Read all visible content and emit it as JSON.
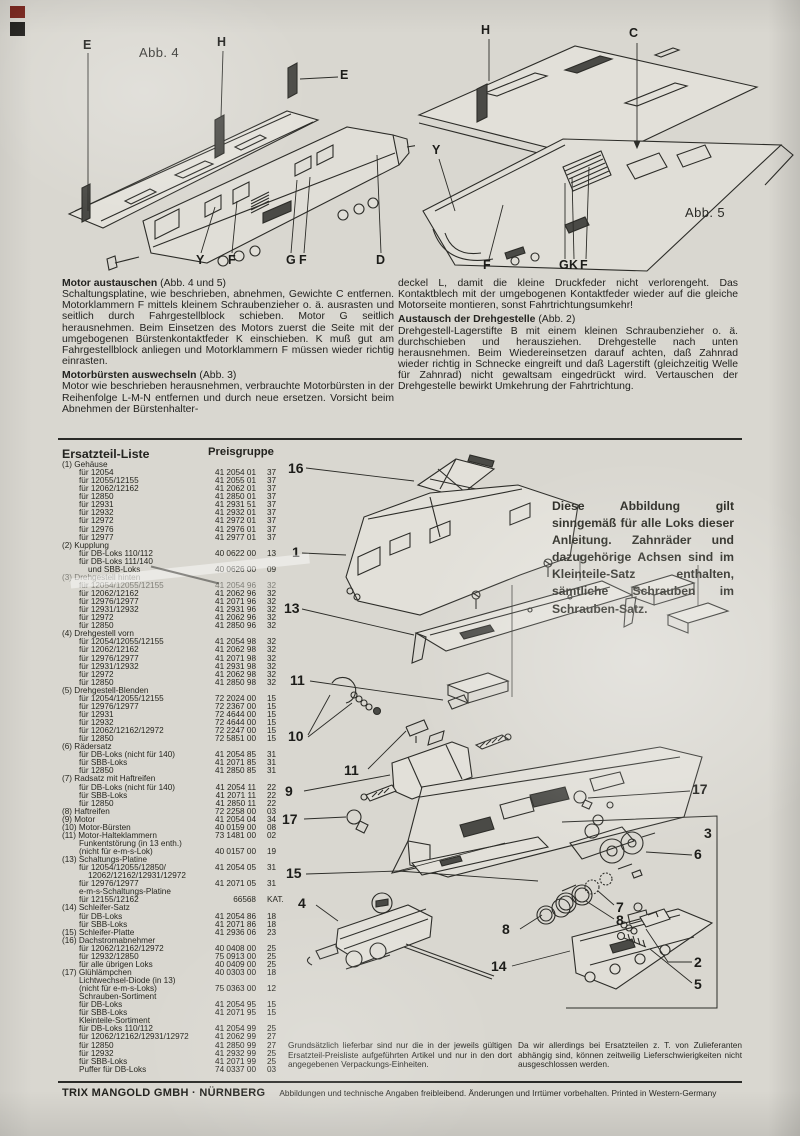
{
  "document": {
    "figures": {
      "fig4": {
        "caption": "Abb. 4",
        "labels": [
          {
            "t": "E",
            "x": 28,
            "y": 14
          },
          {
            "t": "H",
            "x": 162,
            "y": 11
          },
          {
            "t": "E",
            "x": 285,
            "y": 44
          },
          {
            "t": "Y",
            "x": 141,
            "y": 229
          },
          {
            "t": "F",
            "x": 173,
            "y": 229
          },
          {
            "t": "G",
            "x": 231,
            "y": 229
          },
          {
            "t": "F",
            "x": 244,
            "y": 229
          },
          {
            "t": "D",
            "x": 321,
            "y": 229
          }
        ]
      },
      "fig5": {
        "caption": "Abb. 5",
        "labels": [
          {
            "t": "H",
            "x": 66,
            "y": 9
          },
          {
            "t": "C",
            "x": 214,
            "y": 12
          },
          {
            "t": "Y",
            "x": 17,
            "y": 129
          },
          {
            "t": "F",
            "x": 68,
            "y": 244
          },
          {
            "t": "G",
            "x": 144,
            "y": 244
          },
          {
            "t": "K",
            "x": 154,
            "y": 244
          },
          {
            "t": "F",
            "x": 165,
            "y": 244
          }
        ]
      }
    },
    "instructions": {
      "left": [
        {
          "head": "Motor austauschen",
          "head_rest": " (Abb. 4 und 5)",
          "body": "Schaltungsplatine, wie beschrieben, abnehmen, Gewichte C entfernen. Motorklammern F mittels kleinem Schraubenzieher o. ä. ausrasten und seitlich durch Fahrgestellblock schieben. Motor G seitlich herausnehmen. Beim Einsetzen des Motors zuerst die Seite mit der umgebogenen Bürstenkontaktfeder K einschieben. K muß gut am Fahrgestellblock anliegen und Motorklammern F müssen wieder richtig einrasten."
        },
        {
          "head": "Motorbürsten auswechseln",
          "head_rest": " (Abb. 3)",
          "body": "Motor wie beschrieben herausnehmen, verbrauchte Motorbürsten in der Reihenfolge L-M-N entfernen und durch neue ersetzen. Vorsicht beim Abnehmen der Bürstenhalter-"
        }
      ],
      "right": [
        {
          "body": "deckel L, damit die kleine Druckfeder nicht verlorengeht. Das Kontaktblech mit der umgebogenen Kontaktfeder wieder auf die gleiche Motorseite montieren, sonst Fahrtrichtungsumkehr!"
        },
        {
          "head": "Austausch der Drehgestelle",
          "head_rest": " (Abb. 2)",
          "body": "Drehgestell-Lagerstifte B mit einem kleinen Schraubenzieher o. ä. durchschieben und herausziehen. Drehgestelle nach unten herausnehmen. Beim Wiedereinsetzen darauf achten, daß Zahnrad wieder richtig in Schnecke eingreift und daß Lagerstift (gleichzeitig Welle für Zahnrad) nicht gewaltsam eingedrückt wird. Vertauschen der Drehgestelle bewirkt Umkehrung der Fahrtrichtung."
        }
      ]
    },
    "parts": {
      "title": "Ersatzteil-Liste",
      "price_header": "Preisgruppe",
      "rows": [
        {
          "i": 0,
          "t": "(1) Gehäuse"
        },
        {
          "i": 1,
          "t": "für 12054",
          "p": "41 2054 01",
          "g": "37"
        },
        {
          "i": 1,
          "t": "für 12055/12155",
          "p": "41 2055 01",
          "g": "37"
        },
        {
          "i": 1,
          "t": "für 12062/12162",
          "p": "41 2062 01",
          "g": "37"
        },
        {
          "i": 1,
          "t": "für 12850",
          "p": "41 2850 01",
          "g": "37"
        },
        {
          "i": 1,
          "t": "für 12931",
          "p": "41 2931 51",
          "g": "37"
        },
        {
          "i": 1,
          "t": "für 12932",
          "p": "41 2932 01",
          "g": "37"
        },
        {
          "i": 1,
          "t": "für 12972",
          "p": "41 2972 01",
          "g": "37"
        },
        {
          "i": 1,
          "t": "für 12976",
          "p": "41 2976 01",
          "g": "37"
        },
        {
          "i": 1,
          "t": "für 12977",
          "p": "41 2977 01",
          "g": "37"
        },
        {
          "i": 0,
          "t": "(2) Kupplung"
        },
        {
          "i": 1,
          "t": "für DB-Loks 110/112",
          "p": "40 0622 00",
          "g": "13"
        },
        {
          "i": 1,
          "t": "für DB-Loks 111/140"
        },
        {
          "i": 2,
          "t": "und SBB-Loks",
          "p": "40 0626 00",
          "g": "09"
        },
        {
          "i": 0,
          "t": "(3) Drehgestell hinten",
          "f": 1
        },
        {
          "i": 1,
          "t": "für 12054/12055/12155",
          "p": "41 2054 96",
          "g": "32",
          "f": 1
        },
        {
          "i": 1,
          "t": "für 12062/12162",
          "p": "41 2062 96",
          "g": "32"
        },
        {
          "i": 1,
          "t": "für 12976/12977",
          "p": "41 2071 96",
          "g": "32"
        },
        {
          "i": 1,
          "t": "für 12931/12932",
          "p": "41 2931 96",
          "g": "32"
        },
        {
          "i": 1,
          "t": "für 12972",
          "p": "41 2062 96",
          "g": "32"
        },
        {
          "i": 1,
          "t": "für 12850",
          "p": "41 2850 96",
          "g": "32"
        },
        {
          "i": 0,
          "t": "(4) Drehgestell vorn"
        },
        {
          "i": 1,
          "t": "für 12054/12055/12155",
          "p": "41 2054 98",
          "g": "32"
        },
        {
          "i": 1,
          "t": "für 12062/12162",
          "p": "41 2062 98",
          "g": "32"
        },
        {
          "i": 1,
          "t": "für 12976/12977",
          "p": "41 2071 98",
          "g": "32"
        },
        {
          "i": 1,
          "t": "für 12931/12932",
          "p": "41 2931 98",
          "g": "32"
        },
        {
          "i": 1,
          "t": "für 12972",
          "p": "41 2062 98",
          "g": "32"
        },
        {
          "i": 1,
          "t": "für 12850",
          "p": "41 2850 98",
          "g": "32"
        },
        {
          "i": 0,
          "t": "(5) Drehgestell-Blenden"
        },
        {
          "i": 1,
          "t": "für 12054/12055/12155",
          "p": "72 2024 00",
          "g": "15"
        },
        {
          "i": 1,
          "t": "für 12976/12977",
          "p": "72 2367 00",
          "g": "15"
        },
        {
          "i": 1,
          "t": "für 12931",
          "p": "72 4644 00",
          "g": "15"
        },
        {
          "i": 1,
          "t": "für 12932",
          "p": "72 4644 00",
          "g": "15"
        },
        {
          "i": 1,
          "t": "für 12062/12162/12972",
          "p": "72 2247 00",
          "g": "15"
        },
        {
          "i": 1,
          "t": "für 12850",
          "p": "72 5851 00",
          "g": "15"
        },
        {
          "i": 0,
          "t": "(6) Rädersatz"
        },
        {
          "i": 1,
          "t": "für DB-Loks (nicht für 140)",
          "p": "41 2054 85",
          "g": "31"
        },
        {
          "i": 1,
          "t": "für SBB-Loks",
          "p": "41 2071 85",
          "g": "31"
        },
        {
          "i": 1,
          "t": "für 12850",
          "p": "41 2850 85",
          "g": "31"
        },
        {
          "i": 0,
          "t": "(7) Radsatz mit Haftreifen"
        },
        {
          "i": 1,
          "t": "für DB-Loks (nicht für 140)",
          "p": "41 2054 11",
          "g": "22"
        },
        {
          "i": 1,
          "t": "für SBB-Loks",
          "p": "41 2071 11",
          "g": "22"
        },
        {
          "i": 1,
          "t": "für 12850",
          "p": "41 2850 11",
          "g": "22"
        },
        {
          "i": 0,
          "t": "(8) Haftreifen",
          "p": "72 2258 00",
          "g": "03"
        },
        {
          "i": 0,
          "t": "(9) Motor",
          "p": "41 2054 04",
          "g": "34"
        },
        {
          "i": 0,
          "t": "(10) Motor-Bürsten",
          "p": "40 0159 00",
          "g": "08"
        },
        {
          "i": 0,
          "t": "(11) Motor-Halteklammern",
          "p": "73 1481 00",
          "g": "02"
        },
        {
          "i": 1,
          "t": "Funkentstörung (in 13 enth.)"
        },
        {
          "i": 1,
          "t": "(nicht für e-m-s-Lok)",
          "p": "40 0157 00",
          "g": "19"
        },
        {
          "i": 0,
          "t": "(13) Schaltungs-Platine"
        },
        {
          "i": 1,
          "t": "für 12054/12055/12850/",
          "p": "41 2054 05",
          "g": "31"
        },
        {
          "i": 2,
          "t": "12062/12162/12931/12972"
        },
        {
          "i": 1,
          "t": "für 12976/12977",
          "p": "41 2071 05",
          "g": "31"
        },
        {
          "i": 1,
          "t": "e-m-s-Schaltungs-Platine"
        },
        {
          "i": 1,
          "t": "für 12155/12162",
          "p": "66568",
          "g": "KAT."
        },
        {
          "i": 0,
          "t": "(14) Schleifer-Satz"
        },
        {
          "i": 1,
          "t": "für DB-Loks",
          "p": "41 2054 86",
          "g": "18"
        },
        {
          "i": 1,
          "t": "für SBB-Loks",
          "p": "41 2071 86",
          "g": "18"
        },
        {
          "i": 0,
          "t": "(15) Schleifer-Platte",
          "p": "41 2936 06",
          "g": "23"
        },
        {
          "i": 0,
          "t": "(16) Dachstromabnehmer"
        },
        {
          "i": 1,
          "t": "für 12062/12162/12972",
          "p": "40 0408 00",
          "g": "25"
        },
        {
          "i": 1,
          "t": "für 12932/12850",
          "p": "75 0913 00",
          "g": "25"
        },
        {
          "i": 1,
          "t": "für alle übrigen Loks",
          "p": "40 0409 00",
          "g": "25"
        },
        {
          "i": 0,
          "t": "(17) Glühlämpchen",
          "p": "40 0303 00",
          "g": "18"
        },
        {
          "i": 1,
          "t": "Lichtwechsel-Diode (in 13)"
        },
        {
          "i": 1,
          "t": "(nicht für e-m-s-Loks)",
          "p": "75 0363 00",
          "g": "12"
        },
        {
          "i": 1,
          "t": "Schrauben-Sortiment"
        },
        {
          "i": 1,
          "t": "für DB-Loks",
          "p": "41 2054 95",
          "g": "15"
        },
        {
          "i": 1,
          "t": "für SBB-Loks",
          "p": "41 2071 95",
          "g": "15"
        },
        {
          "i": 1,
          "t": "Kleinteile-Sortiment"
        },
        {
          "i": 1,
          "t": "für DB-Loks 110/112",
          "p": "41 2054 99",
          "g": "25"
        },
        {
          "i": 1,
          "t": "für 12062/12162/12931/12972",
          "p": "41 2062 99",
          "g": "27"
        },
        {
          "i": 1,
          "t": "für 12850",
          "p": "41 2850 99",
          "g": "27"
        },
        {
          "i": 1,
          "t": "für 12932",
          "p": "41 2932 99",
          "g": "25"
        },
        {
          "i": 1,
          "t": "für SBB-Loks",
          "p": "41 2071 99",
          "g": "25"
        },
        {
          "i": 1,
          "t": "Puffer für DB-Loks",
          "p": "74 0337 00",
          "g": "03"
        }
      ]
    },
    "diagram": {
      "note": "Diese Abbildung gilt sinngemäß für alle Loks dieser Anleitung. Zahnräder und dazugehörige Achsen sind im Kleinteile-Satz enthalten, sämtliche Schrauben im Schrauben-Satz.",
      "callouts": [
        {
          "t": "16",
          "x": 8,
          "y": 16
        },
        {
          "t": "1",
          "x": 12,
          "y": 100
        },
        {
          "t": "13",
          "x": 4,
          "y": 156
        },
        {
          "t": "11",
          "x": 10,
          "y": 228
        },
        {
          "t": "10",
          "x": 8,
          "y": 284
        },
        {
          "t": "11",
          "x": 64,
          "y": 318
        },
        {
          "t": "9",
          "x": 5,
          "y": 339
        },
        {
          "t": "17",
          "x": 2,
          "y": 367
        },
        {
          "t": "15",
          "x": 6,
          "y": 421
        },
        {
          "t": "4",
          "x": 18,
          "y": 451
        },
        {
          "t": "8",
          "x": 222,
          "y": 477
        },
        {
          "t": "14",
          "x": 211,
          "y": 514
        },
        {
          "t": "17",
          "x": 412,
          "y": 337
        },
        {
          "t": "3",
          "x": 424,
          "y": 381
        },
        {
          "t": "6",
          "x": 414,
          "y": 402
        },
        {
          "t": "7",
          "x": 336,
          "y": 455
        },
        {
          "t": "8",
          "x": 336,
          "y": 468
        },
        {
          "t": "2",
          "x": 414,
          "y": 510
        },
        {
          "t": "5",
          "x": 414,
          "y": 532
        }
      ]
    },
    "notes": {
      "left": "Grundsätzlich lieferbar sind nur die in der jeweils gültigen Ersatzteil-Preisliste aufgeführten Artikel und nur in den dort angegebenen Verpackungs-Einheiten.",
      "right": "Da wir allerdings bei Ersatzteilen z. T. von Zulieferanten abhängig sind, können zeitweilig Lieferschwierigkeiten nicht ausgeschlossen werden."
    },
    "footer": {
      "company": "TRIX MANGOLD GMBH · NÜRNBERG",
      "legal": "Abbildungen und technische Angaben freibleibend. Änderungen und Irrtümer vorbehalten. Printed in Western-Germany"
    }
  }
}
